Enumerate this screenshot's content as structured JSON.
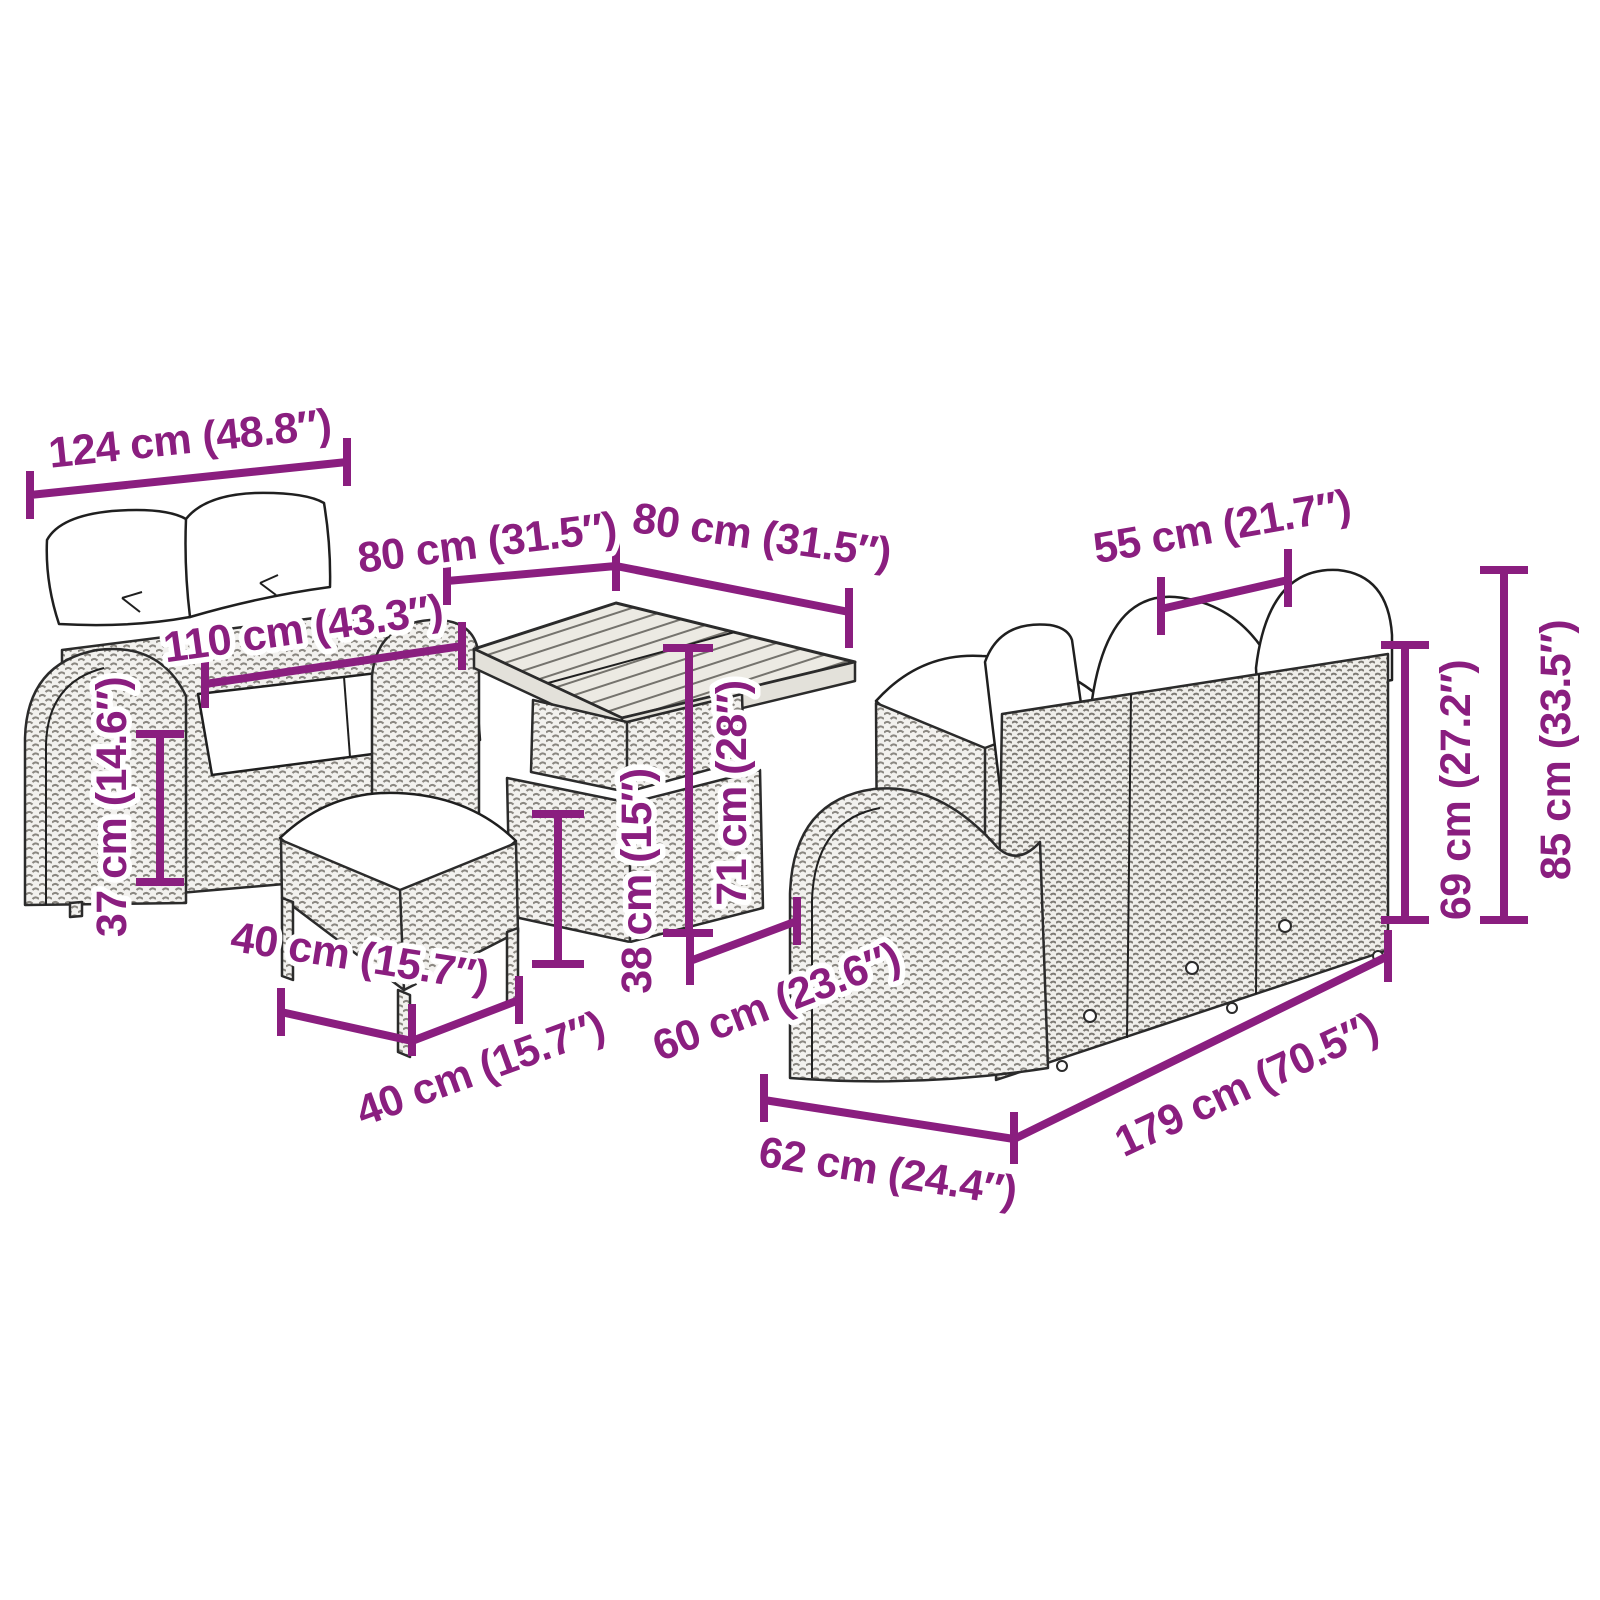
{
  "diagram": {
    "kind": "product-dimension-diagram",
    "subject": "rattan garden furniture set: two-seater sofa, square table, two stools, three-seater sofa"
  },
  "colors": {
    "dimension_text": "#8A1E7F",
    "furniture_outline": "#2b2b2b",
    "rattan_fill": "#f2f1ee",
    "cushion_fill": "#ffffff",
    "background": "#ffffff"
  },
  "furniture": {
    "two_seater_sofa": "two-seater sofa",
    "dining_table": "square dining table",
    "stool_front": "front stool with cushion",
    "stool_back": "back stool with cushion",
    "three_seater_sofa": "three-seater sofa"
  },
  "dims": [
    {
      "id": "sofa2-width",
      "label": "124 cm (48.8″)"
    },
    {
      "id": "sofa2-seat-width",
      "label": "110 cm (43.3″)"
    },
    {
      "id": "table-width",
      "label": "80 cm (31.5″)"
    },
    {
      "id": "table-depth",
      "label": "80 cm (31.5″)"
    },
    {
      "id": "seat-width",
      "label": "55 cm (21.7″)"
    },
    {
      "id": "sofa3-height",
      "label": "85 cm (33.5″)"
    },
    {
      "id": "sofa3-back-height",
      "label": "69 cm (27.2″)"
    },
    {
      "id": "table-height",
      "label": "71 cm (28″)"
    },
    {
      "id": "stool-height",
      "label": "38 cm (15″)"
    },
    {
      "id": "sofa2-seat-height",
      "label": "37 cm (14.6″)"
    },
    {
      "id": "stool-width",
      "label": "40 cm (15.7″)"
    },
    {
      "id": "stool-depth",
      "label": "40 cm (15.7″)"
    },
    {
      "id": "seat-depth",
      "label": "60 cm (23.6″)"
    },
    {
      "id": "sofa3-depth",
      "label": "62 cm (24.4″)"
    },
    {
      "id": "sofa3-width",
      "label": "179 cm (70.5″)"
    }
  ]
}
